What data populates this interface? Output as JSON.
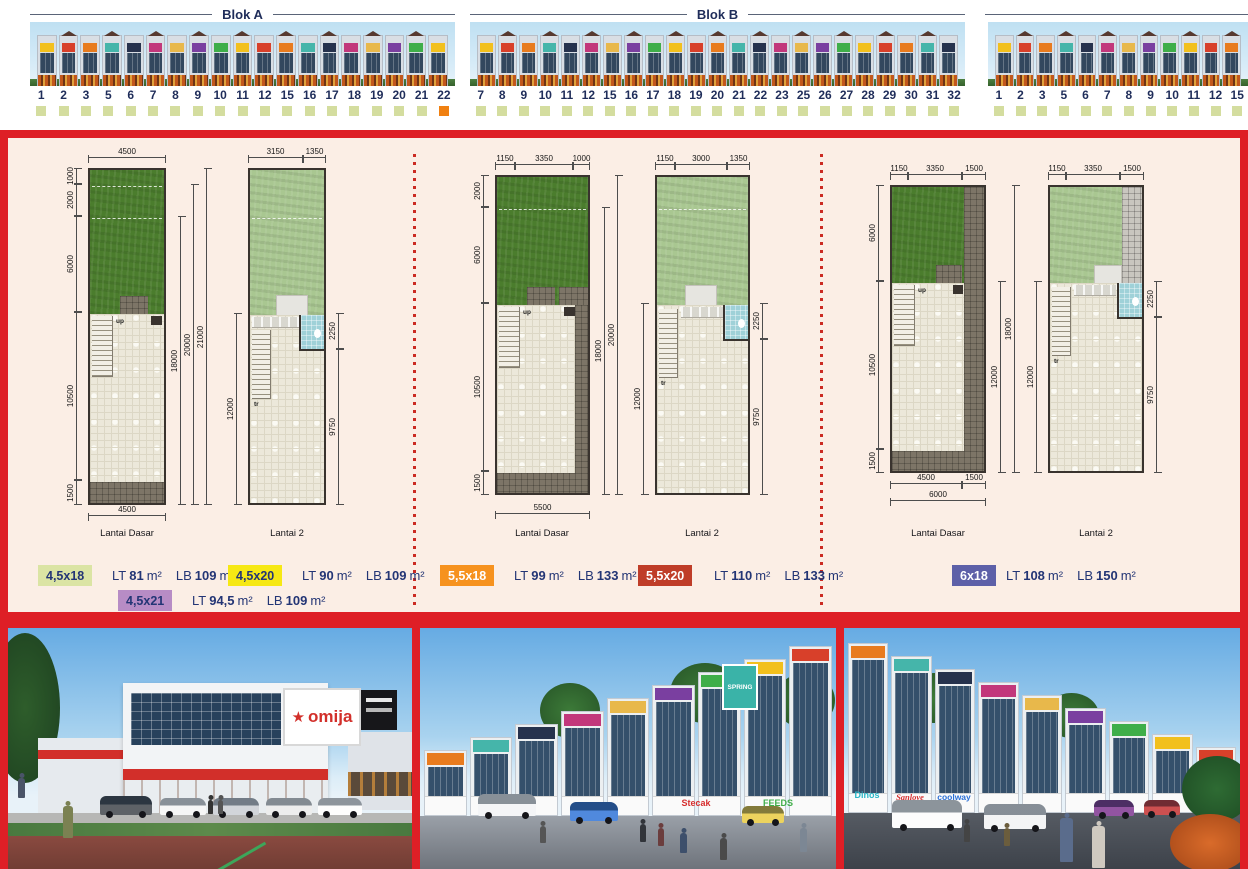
{
  "blocks": {
    "a": {
      "label": "Blok A",
      "units": [
        {
          "n": "1",
          "st": "a"
        },
        {
          "n": "2",
          "st": "a"
        },
        {
          "n": "3",
          "st": "a"
        },
        {
          "n": "5",
          "st": "a"
        },
        {
          "n": "6",
          "st": "a"
        },
        {
          "n": "7",
          "st": "a"
        },
        {
          "n": "8",
          "st": "a"
        },
        {
          "n": "9",
          "st": "a"
        },
        {
          "n": "10",
          "st": "a"
        },
        {
          "n": "11",
          "st": "a"
        },
        {
          "n": "12",
          "st": "a"
        },
        {
          "n": "15",
          "st": "a"
        },
        {
          "n": "16",
          "st": "a"
        },
        {
          "n": "17",
          "st": "a"
        },
        {
          "n": "18",
          "st": "a"
        },
        {
          "n": "19",
          "st": "a"
        },
        {
          "n": "20",
          "st": "a"
        },
        {
          "n": "21",
          "st": "a"
        },
        {
          "n": "22",
          "st": "b"
        }
      ]
    },
    "b": {
      "label": "Blok B",
      "units": [
        {
          "n": "7",
          "st": "a"
        },
        {
          "n": "8",
          "st": "a"
        },
        {
          "n": "9",
          "st": "a"
        },
        {
          "n": "10",
          "st": "a"
        },
        {
          "n": "11",
          "st": "a"
        },
        {
          "n": "12",
          "st": "a"
        },
        {
          "n": "15",
          "st": "a"
        },
        {
          "n": "16",
          "st": "a"
        },
        {
          "n": "17",
          "st": "a"
        },
        {
          "n": "18",
          "st": "a"
        },
        {
          "n": "19",
          "st": "a"
        },
        {
          "n": "20",
          "st": "a"
        },
        {
          "n": "21",
          "st": "a"
        },
        {
          "n": "22",
          "st": "a"
        },
        {
          "n": "23",
          "st": "a"
        },
        {
          "n": "25",
          "st": "a"
        },
        {
          "n": "26",
          "st": "a"
        },
        {
          "n": "27",
          "st": "a"
        },
        {
          "n": "28",
          "st": "a"
        },
        {
          "n": "29",
          "st": "a"
        },
        {
          "n": "30",
          "st": "a"
        },
        {
          "n": "31",
          "st": "a"
        },
        {
          "n": "32",
          "st": "a"
        }
      ]
    },
    "c": {
      "label": "",
      "units": [
        {
          "n": "1",
          "st": "a"
        },
        {
          "n": "2",
          "st": "a"
        },
        {
          "n": "3",
          "st": "a"
        },
        {
          "n": "5",
          "st": "a"
        },
        {
          "n": "6",
          "st": "a"
        },
        {
          "n": "7",
          "st": "a"
        },
        {
          "n": "8",
          "st": "a"
        },
        {
          "n": "9",
          "st": "a"
        },
        {
          "n": "10",
          "st": "a"
        },
        {
          "n": "11",
          "st": "a"
        },
        {
          "n": "12",
          "st": "a"
        },
        {
          "n": "15",
          "st": "a"
        }
      ]
    }
  },
  "status_colors": {
    "a": "#d4dd9f",
    "b": "#f08011"
  },
  "decor": {
    "sign_palette": [
      "#f2c01d",
      "#d8402a",
      "#e87b1e",
      "#45b5aa",
      "#26324d",
      "#c2377b",
      "#e8b84b",
      "#7a3fa0",
      "#3fae49"
    ]
  },
  "plans": {
    "g1": {
      "dasar": {
        "caption": "Lantai Dasar",
        "top": [
          "4500"
        ],
        "bottom": [
          "4500"
        ],
        "left": [
          "1000",
          "2000",
          "6000",
          "10500",
          "1500"
        ],
        "right": [
          "18000",
          "20000",
          "21000"
        ]
      },
      "l2": {
        "caption": "Lantai 2",
        "top": [
          "3150",
          "1350"
        ],
        "left": [
          "12000"
        ],
        "right": [
          "2250",
          "9750"
        ]
      }
    },
    "g2": {
      "dasar": {
        "caption": "Lantai Dasar",
        "top": [
          "1150",
          "3350",
          "1000"
        ],
        "bottom": [
          "5500"
        ],
        "left": [
          "2000",
          "6000",
          "10500",
          "1500"
        ],
        "right": [
          "18000",
          "20000"
        ]
      },
      "l2": {
        "caption": "Lantai 2",
        "top": [
          "1150",
          "3000",
          "1350"
        ],
        "left": [
          "12000"
        ],
        "right": [
          "2250",
          "9750"
        ]
      }
    },
    "g3": {
      "dasar": {
        "caption": "Lantai Dasar",
        "top": [
          "1150",
          "3350",
          "1500"
        ],
        "bottom": [
          "4500",
          "1500",
          "6000"
        ],
        "left": [
          "6000",
          "10500",
          "1500"
        ],
        "right": [
          "12000",
          "18000"
        ]
      },
      "l2": {
        "caption": "Lantai 2",
        "top": [
          "1150",
          "3350",
          "1500"
        ],
        "left": [
          "12000"
        ],
        "right": [
          "2250",
          "9750"
        ]
      }
    }
  },
  "plan_labels": {
    "up": "up",
    "tr": "tr"
  },
  "legend_labels": {
    "lt": "LT",
    "lb": "LB",
    "m2": "m²"
  },
  "types": [
    {
      "code": "4,5x18",
      "lt": "81",
      "lb": "109",
      "bg": "#dbe4a4",
      "fg": "#233575"
    },
    {
      "code": "4,5x20",
      "lt": "90",
      "lb": "109",
      "bg": "#f6e814",
      "fg": "#233575"
    },
    {
      "code": "4,5x21",
      "lt": "94,5",
      "lb": "109",
      "bg": "#b78cc5",
      "fg": "#233575"
    },
    {
      "code": "5,5x18",
      "lt": "99",
      "lb": "133",
      "bg": "#f6921e",
      "fg": "#ffffff"
    },
    {
      "code": "5,5x20",
      "lt": "110",
      "lb": "133",
      "bg": "#bf3d28",
      "fg": "#ffffff"
    },
    {
      "code": "6x18",
      "lt": "108",
      "lb": "150",
      "bg": "#5d60a8",
      "fg": "#ffffff"
    }
  ],
  "photos": {
    "p1": {
      "sign_star": "★",
      "sign": "omija"
    },
    "p2": {
      "sign1": "SPRING",
      "sign2": "Stecak",
      "sign3": "FEEDS"
    },
    "p3": {
      "sign1": "Dinos",
      "sign2": "coolway",
      "sign3": "Sanlove"
    }
  }
}
